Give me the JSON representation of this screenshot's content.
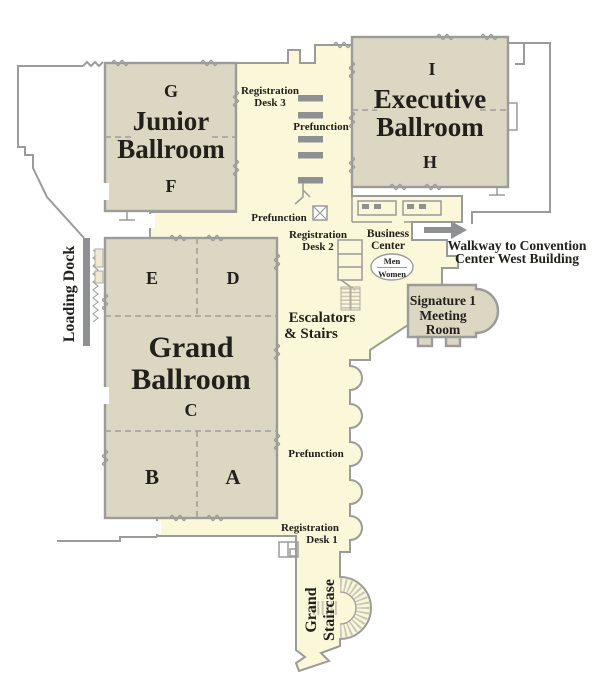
{
  "map_title": "Convention Center Ballroom Level Floor Plan",
  "colors": {
    "floor": "#fbf8d9",
    "room_fill": "#dbd7c3",
    "wall": "#9b9b99",
    "furniture_gray": "#8e9092",
    "text": "#21201b"
  },
  "rooms": {
    "junior_ballroom": {
      "name_line1": "Junior",
      "name_line2": "Ballroom",
      "sections": [
        "G",
        "F"
      ]
    },
    "executive_ballroom": {
      "name_line1": "Executive",
      "name_line2": "Ballroom",
      "sections": [
        "I",
        "H"
      ]
    },
    "grand_ballroom": {
      "name_line1": "Grand",
      "name_line2": "Ballroom",
      "sections": [
        "E",
        "D",
        "C",
        "B",
        "A"
      ]
    },
    "signature_meeting_room": {
      "line1": "Signature 1",
      "line2": "Meeting",
      "line3": "Room"
    }
  },
  "labels": {
    "registration_desk_3": {
      "line1": "Registration",
      "line2": "Desk 3"
    },
    "registration_desk_2": {
      "line1": "Registration",
      "line2": "Desk 2"
    },
    "registration_desk_1": {
      "line1": "Registration",
      "line2": "Desk 1"
    },
    "prefunction_top": "Prefunction",
    "prefunction_mid": "Prefunction",
    "prefunction_lower": "Prefunction",
    "business_center": {
      "line1": "Business",
      "line2": "Center"
    },
    "restrooms": {
      "men": "Men",
      "women": "Women"
    },
    "escalators": {
      "line1": "Escalators",
      "line2": "& Stairs"
    },
    "walkway": {
      "line1": "Walkway to Convention",
      "line2": "Center West Building"
    },
    "loading_dock": "Loading Dock",
    "grand_staircase": {
      "line1": "Grand",
      "line2": "Staircase"
    }
  }
}
